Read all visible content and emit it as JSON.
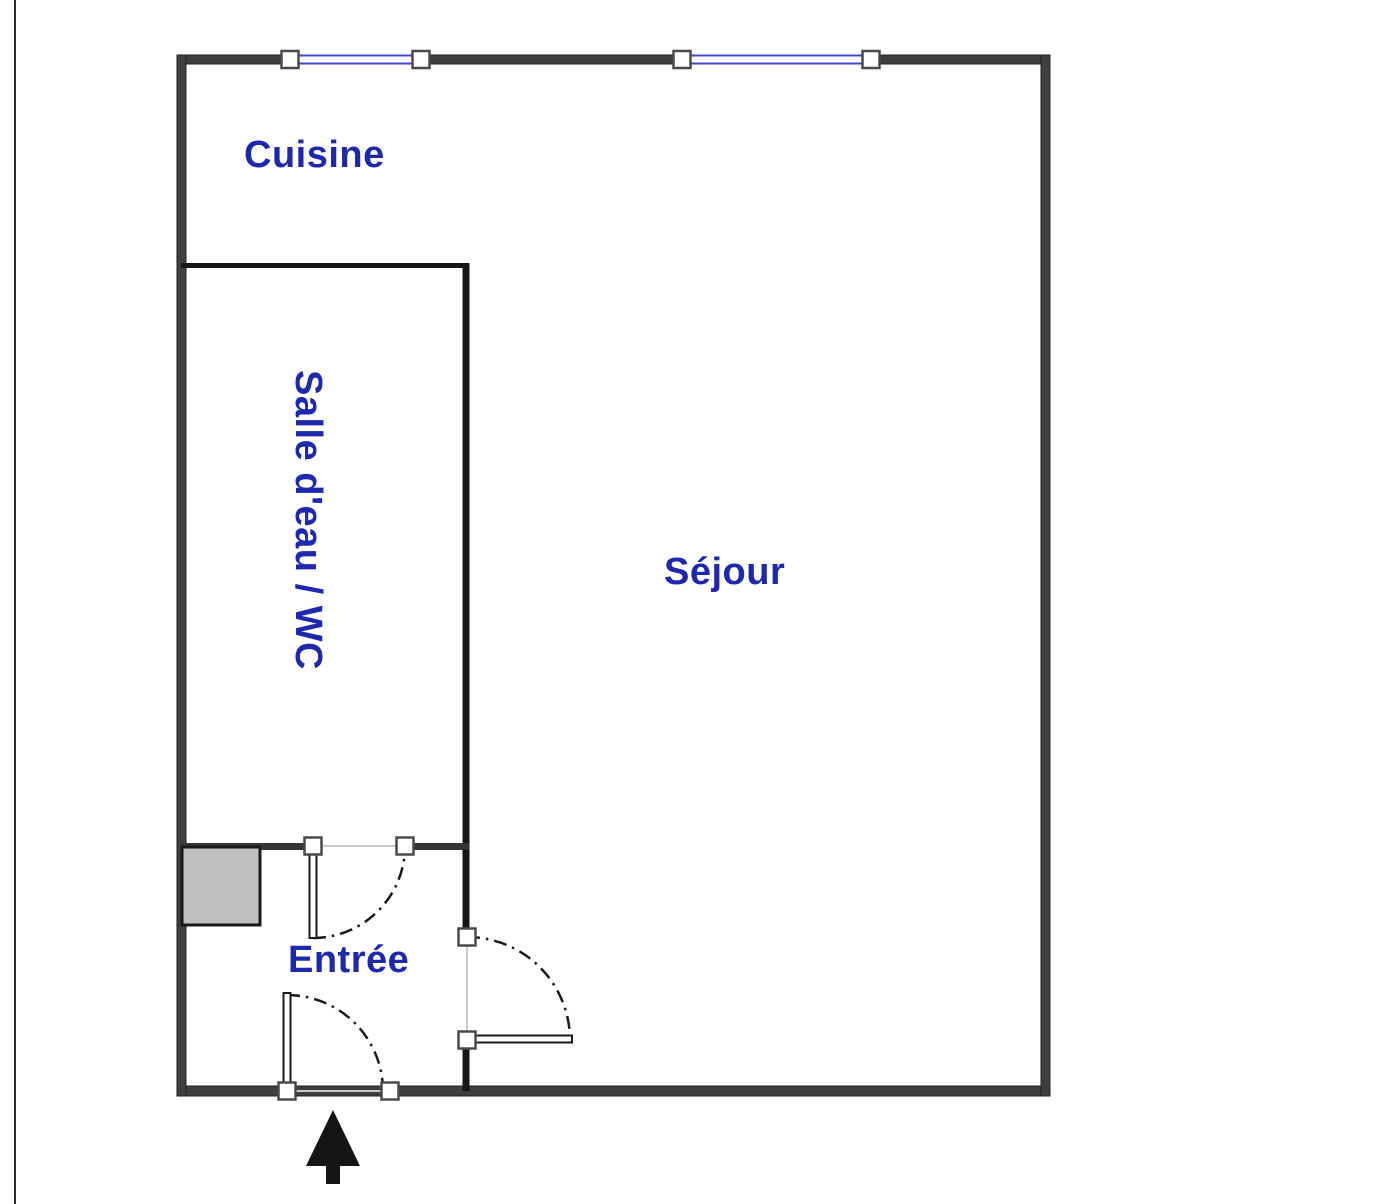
{
  "plan": {
    "title": "Studio apartment floor plan",
    "rooms": [
      {
        "id": "cuisine",
        "label": "Cuisine"
      },
      {
        "id": "salle-eau-wc",
        "label": "Salle d'eau / WC"
      },
      {
        "id": "sejour",
        "label": "Séjour"
      },
      {
        "id": "entree",
        "label": "Entrée"
      }
    ],
    "features": {
      "windows_count": 2,
      "doors_count": 3,
      "entrance_arrow": "entrance-arrow-up"
    },
    "colors": {
      "label_blue": "#1e28ad",
      "window_blue": "#4646c8",
      "wall_gray": "#3f3f3f",
      "interior_black": "#161616",
      "cabinet_gray": "#bfbfbf",
      "arc_black": "#1a1a1a",
      "background": "#ffffff"
    }
  }
}
